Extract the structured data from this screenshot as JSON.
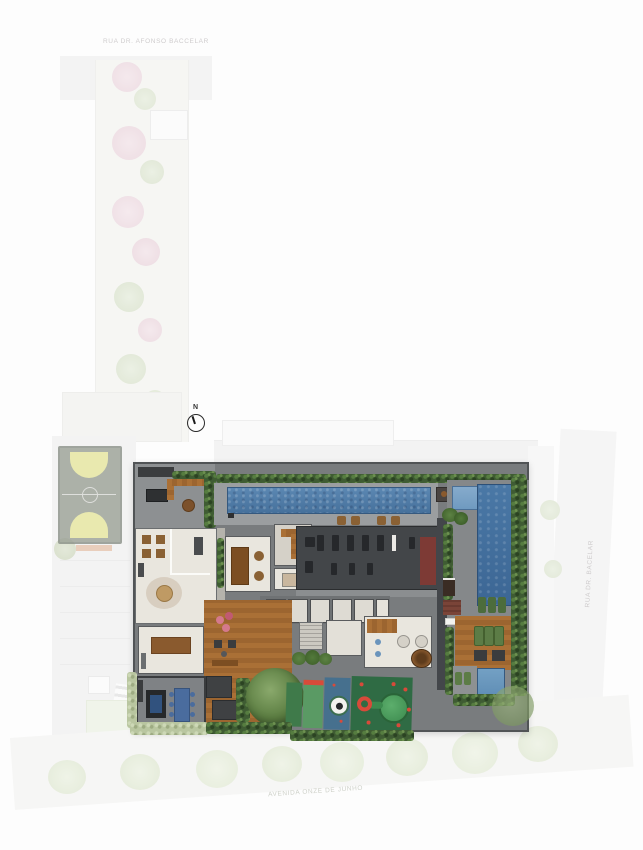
{
  "streets": {
    "top": "RUA DR. AFONSO BACCELAR",
    "bottom": "AVENIDA ONZE DE JUNHO",
    "right": "RUA DR. BACELAR"
  },
  "compass": {
    "label": "N"
  },
  "palette": {
    "water": "#4d7aa6",
    "water_deep": "#3c6694",
    "hedge_green": "#3f5c33",
    "deck_wood": "#aa7036",
    "gym_floor": "#434649",
    "room_floor": "#e9e6de",
    "terrace_gray": "#8d9092",
    "playground_green": "#2f6b44",
    "playground_blue": "#46708e",
    "accent_red": "#d84a3a",
    "pouf_pink": "#d4798c",
    "court_yellow": "#e6e79e",
    "faded_street": "#efefef"
  }
}
